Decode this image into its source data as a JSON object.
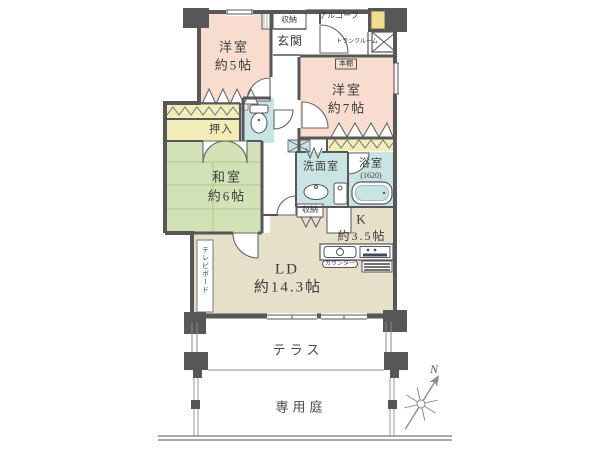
{
  "labels": {
    "bedroom5_name": "洋室",
    "bedroom5_size": "約5帖",
    "bedroom7_name": "洋室",
    "bedroom7_size": "約7帖",
    "bookshelf": "本棚",
    "tatami_name": "和室",
    "tatami_size": "約6帖",
    "oshiire": "押入",
    "genkan": "玄関",
    "storage_top": "収納",
    "alcove": "アルコーブ",
    "trunk_room": "トランクルーム",
    "washroom": "洗面室",
    "bath_name": "浴室",
    "bath_size": "(1620)",
    "kitchen_name": "K",
    "kitchen_size": "約3.5帖",
    "living_name": "LD",
    "living_size": "約14.3帖",
    "storage_mid": "収納",
    "counter": "カウンター",
    "tv_board": "テレビボード",
    "terrace": "テラス",
    "garden": "専用庭",
    "compass_n": "N"
  },
  "colors": {
    "wall": "#575757",
    "bedroom": "#f8dcd0",
    "tatami": "#d3e2b6",
    "tatami-line": "#adc88d",
    "closet": "#f3eeb9",
    "wet": "#c9e4e2",
    "ldk": "#e6e0ca",
    "mb": "#efdf8d",
    "line": "#555555",
    "faint": "#8a8a8a"
  }
}
